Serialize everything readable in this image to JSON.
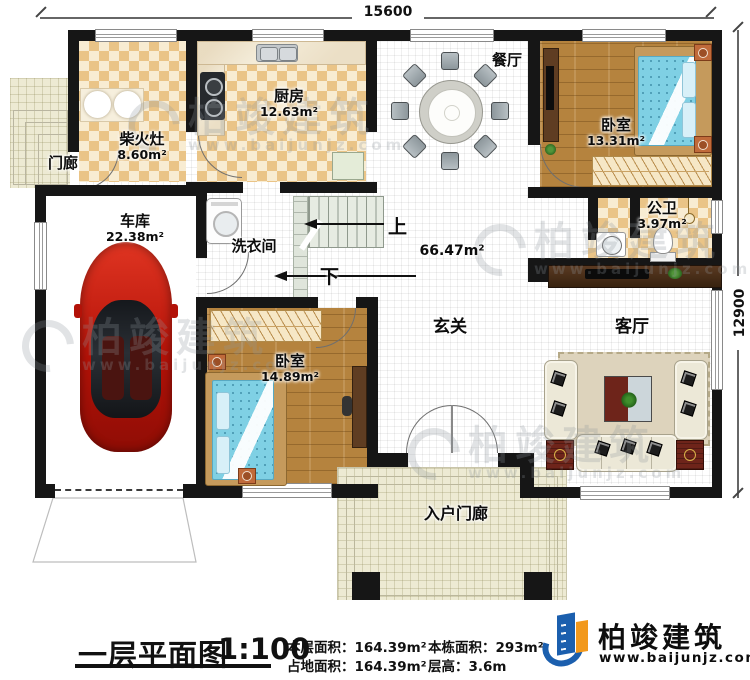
{
  "dimensions": {
    "top": "15600",
    "right": "12900"
  },
  "rooms": {
    "porch": {
      "label": "门廊"
    },
    "wood_stove": {
      "label": "柴火灶",
      "area": "8.60m²"
    },
    "kitchen": {
      "label": "厨房",
      "area": "12.63m²"
    },
    "dining": {
      "label": "餐厅"
    },
    "bedroom_top": {
      "label": "卧室",
      "area": "13.31m²"
    },
    "bathroom": {
      "label": "公卫",
      "area": "3.97m²"
    },
    "garage": {
      "label": "车库",
      "area": "22.38m²"
    },
    "laundry": {
      "label": "洗衣间"
    },
    "foyer": {
      "label": "玄关"
    },
    "hall": {
      "area": "66.47m²"
    },
    "living": {
      "label": "客厅"
    },
    "bedroom_bottom": {
      "label": "卧室",
      "area": "14.89m²"
    },
    "entry_porch": {
      "label": "入户门廊"
    }
  },
  "stairs": {
    "up_label": "上",
    "down_label": "下"
  },
  "footer": {
    "title": "一层平面图",
    "scale": "1:100",
    "stats": [
      {
        "label": "本层面积：",
        "value": "164.39m²"
      },
      {
        "label": "占地面积：",
        "value": "164.39m²"
      },
      {
        "label": "本栋面积：",
        "value": "293m²"
      },
      {
        "label": "层高：",
        "value": "3.6m"
      }
    ]
  },
  "brand": {
    "name": "柏竣建筑",
    "url": "www.baijunjz.com"
  },
  "watermark": {
    "name": "柏竣建筑",
    "url": "www.baijunjz.com"
  },
  "colors": {
    "wall": "#161616",
    "tile_tan": "#eac487",
    "tile_cream": "#f8ecd2",
    "wood_floor": "#b5833e",
    "bed_blue": "#7fd0e4",
    "car_red": "#c41309",
    "brand_blue": "#1b5fae",
    "brand_orange": "#f2991d"
  }
}
